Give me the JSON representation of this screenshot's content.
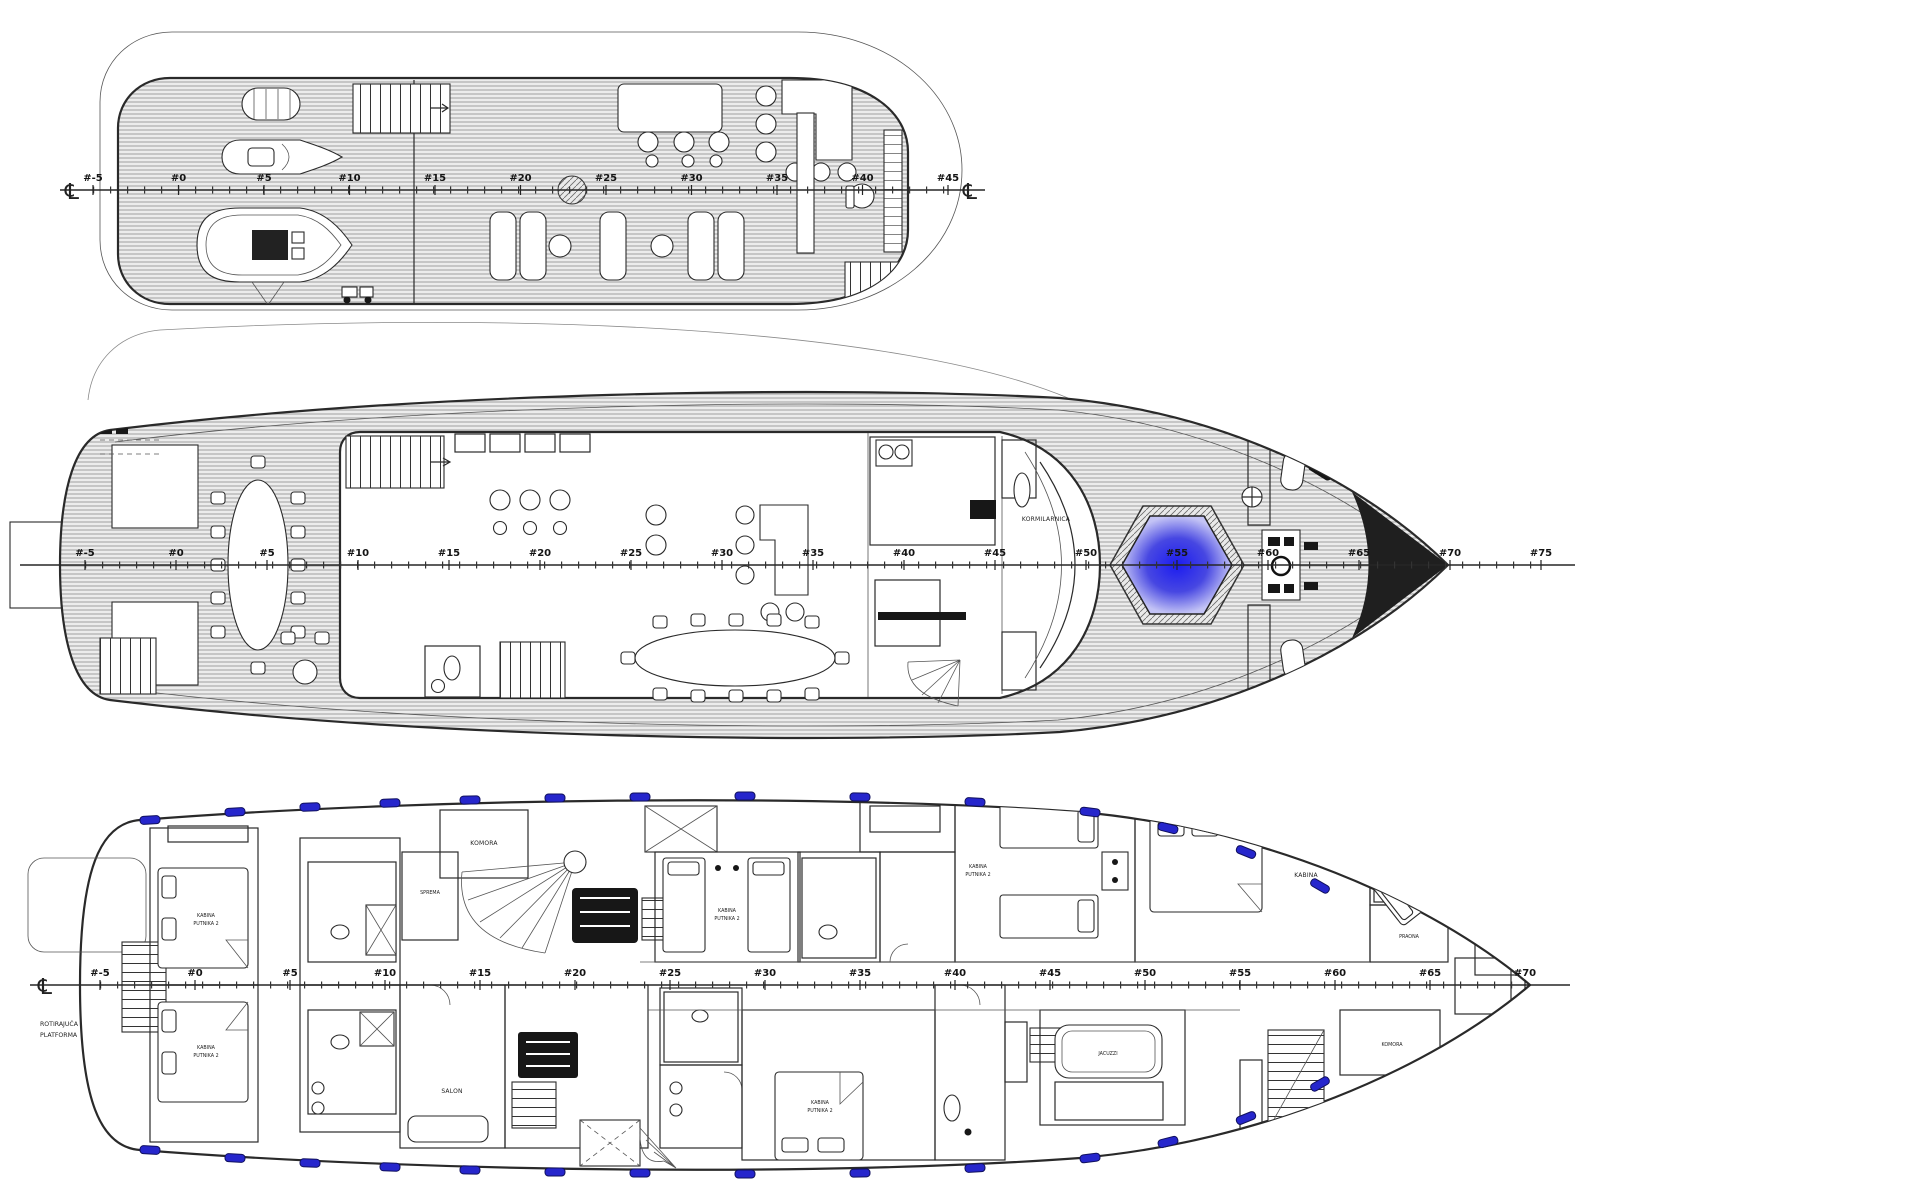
{
  "symbols": {
    "centerline": "℄"
  },
  "colors": {
    "porthole_blue": "#2626cc",
    "porthole_edge": "#10105e",
    "pool_blue_center": "#1c1cf0",
    "pool_blue_mid": "#4747e2",
    "pool_blue_edge": "#c3c3f5",
    "bow_marker": "#1f1f1f"
  },
  "decks": {
    "sun": {
      "stations": [
        "#-5",
        "#0",
        "#5",
        "#10",
        "#15",
        "#20",
        "#25",
        "#30",
        "#35",
        "#40",
        "#45"
      ]
    },
    "main": {
      "stations": [
        "#-5",
        "#0",
        "#5",
        "#10",
        "#15",
        "#20",
        "#25",
        "#30",
        "#35",
        "#40",
        "#45",
        "#50",
        "#55",
        "#60",
        "#65",
        "#70",
        "#75"
      ]
    },
    "lower": {
      "stations": [
        "#-5",
        "#0",
        "#5",
        "#10",
        "#15",
        "#20",
        "#25",
        "#30",
        "#35",
        "#40",
        "#45",
        "#50",
        "#55",
        "#60",
        "#65",
        "#70"
      ]
    }
  },
  "labels": {
    "wheelhouse": "KORMILARNICA",
    "rotating_platform": [
      "ROTIRAJUĆA",
      "PLATFORMA"
    ],
    "passenger_cabin": [
      "KABINA",
      "PUTNIKA 2"
    ],
    "double_cabin": "KABINA",
    "crew_cabin": [
      "KABINA",
      "POSADE"
    ],
    "storage_komora": "KOMORA",
    "storage_sprema": "SPREMA",
    "salon": "SALON",
    "laundry": "PRAONA",
    "jacuzzi": "JACUZZI"
  }
}
